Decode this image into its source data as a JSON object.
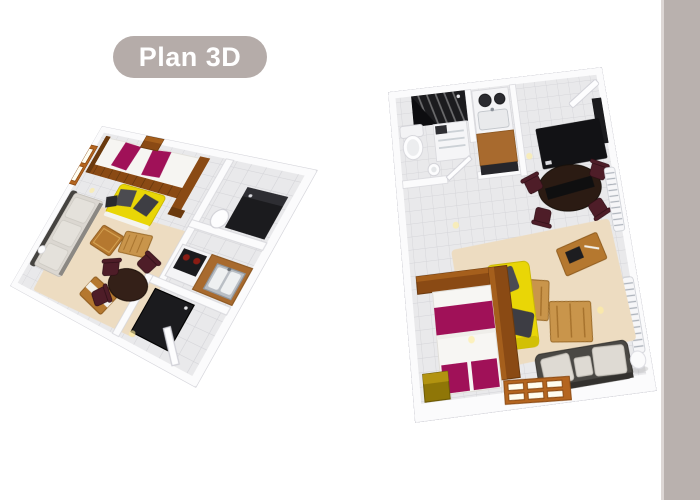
{
  "badge": {
    "label": "Plan 3D"
  },
  "colors": {
    "page_bg": "#ffffff",
    "badge_bg": "#b5aca9",
    "badge_text": "#ffffff",
    "side_strip": "#b9b1ae",
    "side_strip_edge": "#ddd7d5",
    "wall": "#fbfbfc",
    "wall_line": "#d3d3d9",
    "tile": "#e9e9eb",
    "tile_line": "#d5d5d9",
    "wood": "#8a4a14",
    "wood_dark": "#6b3a0e",
    "wood_light": "#b4651f",
    "magenta": "#a01158",
    "sofa_yellow": "#e9d606",
    "rug": "#eddcc1",
    "table_wood": "#b5782f",
    "table_wood_light": "#c9954b",
    "dark_furniture": "#1b1b1e",
    "chair_maroon": "#4e1d28",
    "couch_gray": "#dbd7d1",
    "couch_frame": "#454340",
    "kitchen_wood": "#a86a2e",
    "light_glow": "rgba(255,238,160,0.65)"
  },
  "plans": {
    "left": {
      "view": "studio apartment, angled 3D perspective view",
      "rooms": [
        "living-room",
        "kitchen",
        "bathroom",
        "entry"
      ]
    },
    "right": {
      "view": "apartment, top-down 3D view",
      "rooms": [
        "bathroom",
        "kitchen",
        "dining-area",
        "living-room",
        "sleeping-area"
      ]
    }
  }
}
